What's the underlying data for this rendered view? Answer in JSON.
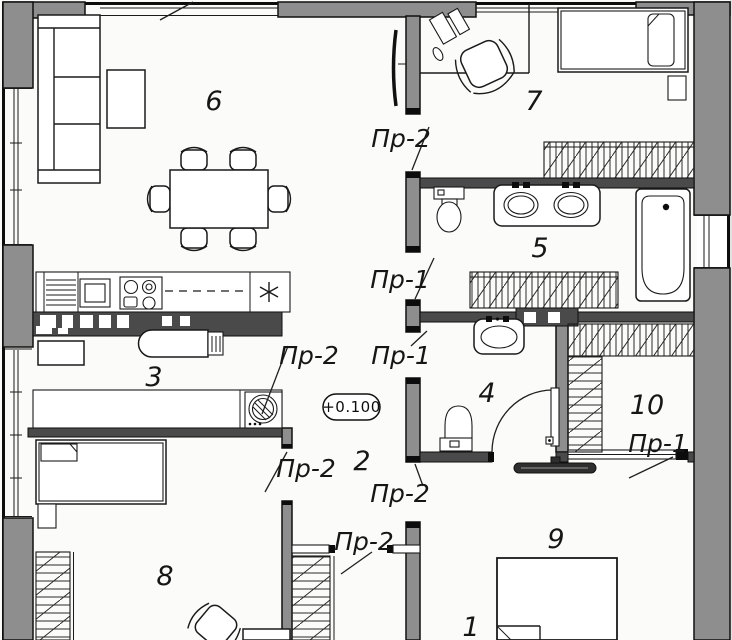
{
  "drawing": {
    "type": "apartment floor plan",
    "elevation_mark": "+0.100",
    "opening_label_pr1": "Пр-1",
    "opening_label_pr2": "Пр-2",
    "room_numbers": {
      "r1": "1",
      "r2": "2",
      "r3": "3",
      "r4": "4",
      "r5": "5",
      "r6": "6",
      "r7": "7",
      "r8": "8",
      "r9": "9",
      "r10": "10"
    }
  },
  "colors": {
    "paper": "#fbfbf9",
    "wall_gray": "#8e8e8e",
    "wall_dark": "#4a4a4a",
    "ink": "#1a1a1a"
  }
}
